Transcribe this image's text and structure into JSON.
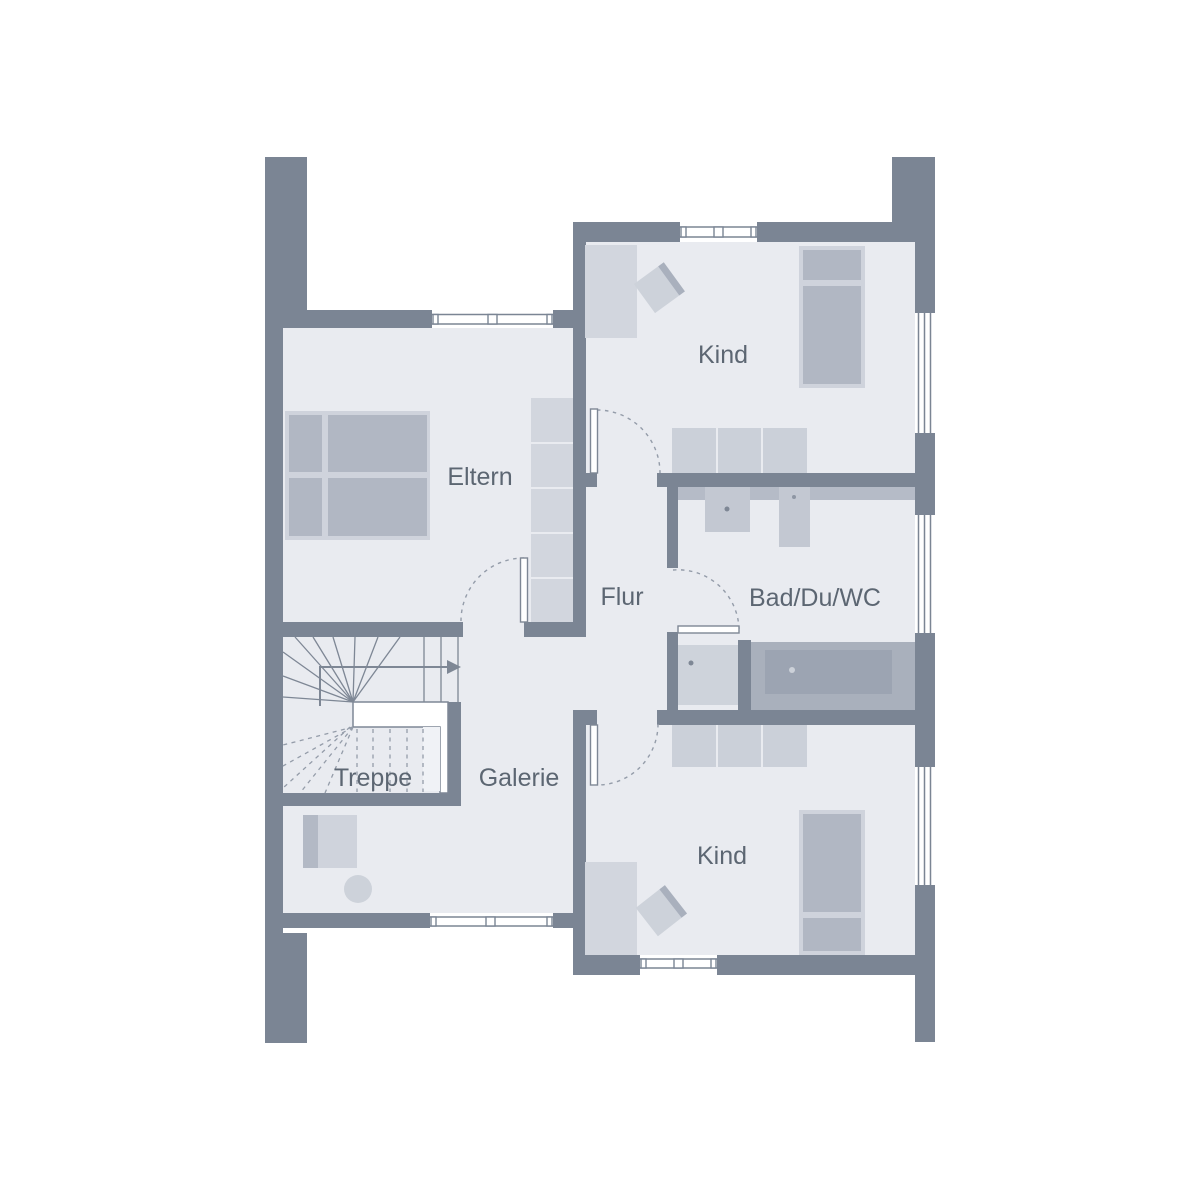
{
  "plan": {
    "type": "floor-plan",
    "floor_shown": "upper-floor",
    "rooms": [
      {
        "name": "kind-top",
        "label": "Kind"
      },
      {
        "name": "eltern",
        "label": "Eltern"
      },
      {
        "name": "flur",
        "label": "Flur"
      },
      {
        "name": "bad-du-wc",
        "label": "Bad/Du/WC"
      },
      {
        "name": "treppe",
        "label": "Treppe"
      },
      {
        "name": "galerie",
        "label": "Galerie"
      },
      {
        "name": "kind-bottom",
        "label": "Kind"
      }
    ],
    "icons": {
      "stairs-direction-arrow": "right-arrow",
      "door-swing": "dashed-quarter-arc",
      "window": "white-band-with-frame-lines"
    },
    "colors": {
      "wall": "#7b8594",
      "floor": "#e9ebf0",
      "outside": "#ffffff",
      "furniture_light": "#d2d6de",
      "furniture_mid": "#cbd0d9",
      "bed_panel": "#b1b7c3",
      "bed_frame": "#cfd3dc",
      "counter": "#b5bbc7",
      "tub_deck": "#a9b0bc",
      "tub_inner": "#9ca4b2",
      "line": "#7e8795",
      "dash": "#949ca9",
      "label_text": "#5c6672"
    }
  }
}
